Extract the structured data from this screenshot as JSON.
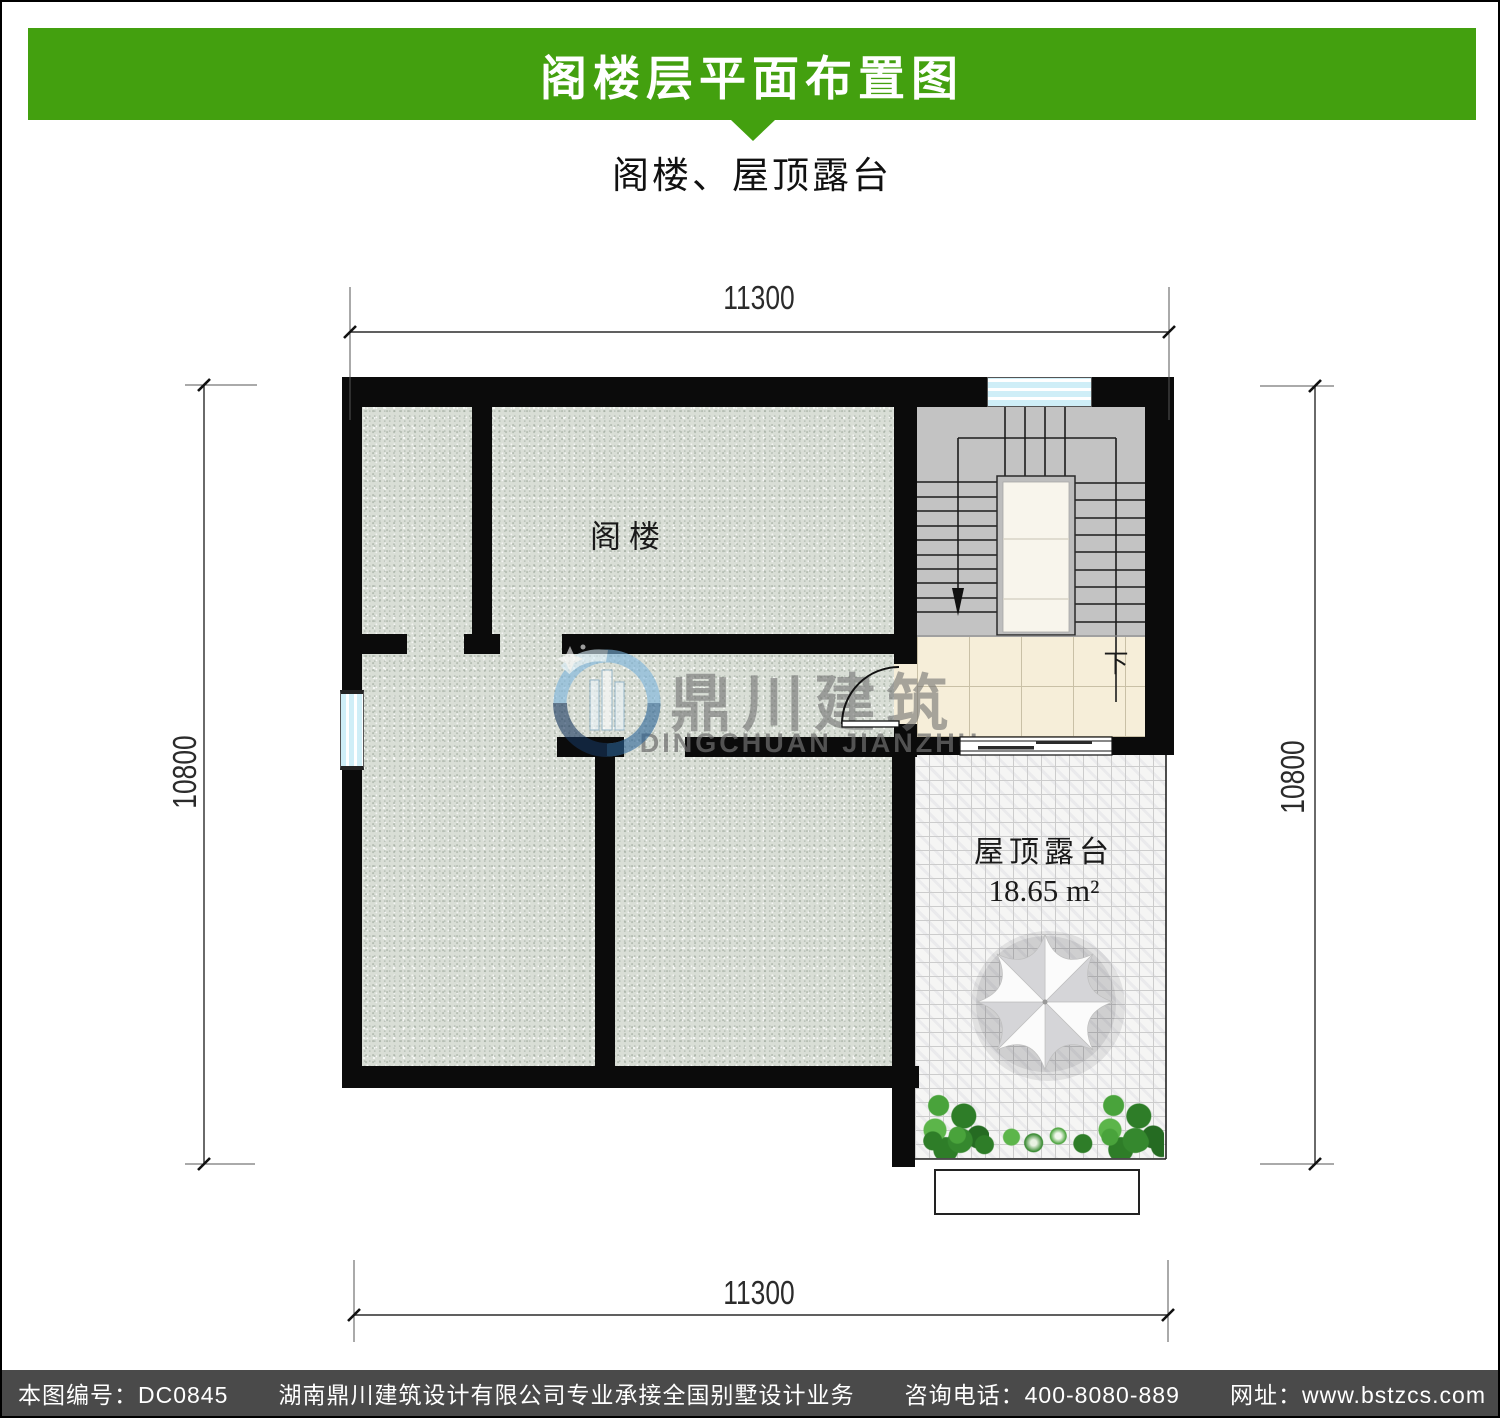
{
  "header": {
    "title": "阁楼层平面布置图",
    "subtitle": "阁楼、屋顶露台"
  },
  "plan": {
    "room_labels": {
      "attic": "阁楼",
      "terrace": "屋顶露台",
      "terrace_area": "18.65 m²",
      "stair_down": "下"
    },
    "dimensions": {
      "top": "11300",
      "bottom": "11300",
      "left": "10800",
      "right": "10800"
    }
  },
  "watermark": {
    "logo": "dingchuan-building-logo",
    "cn": "鼎川建筑",
    "en": "DINGCHUAN JIANZHU"
  },
  "footer": {
    "parts": [
      "本图编号：DC0845",
      "湖南鼎川建筑设计有限公司专业承接全国别墅设计业务",
      "咨询电话：400-8080-889",
      "网址：www.bstzcs.com"
    ]
  },
  "colors": {
    "banner_green": "#43a00f",
    "footer_gray": "#4a4a4a",
    "wall_black": "#0b0b0b",
    "attic_floor": "#d9ded6",
    "stair_gray": "#c3c3c3",
    "hall_beige": "#f6eed9",
    "terrace_white": "#f5f5f4",
    "window_glass": "#cfeef7",
    "watermark_gray": "#6e6e6e",
    "logo_blue": "#5b9fd0"
  }
}
